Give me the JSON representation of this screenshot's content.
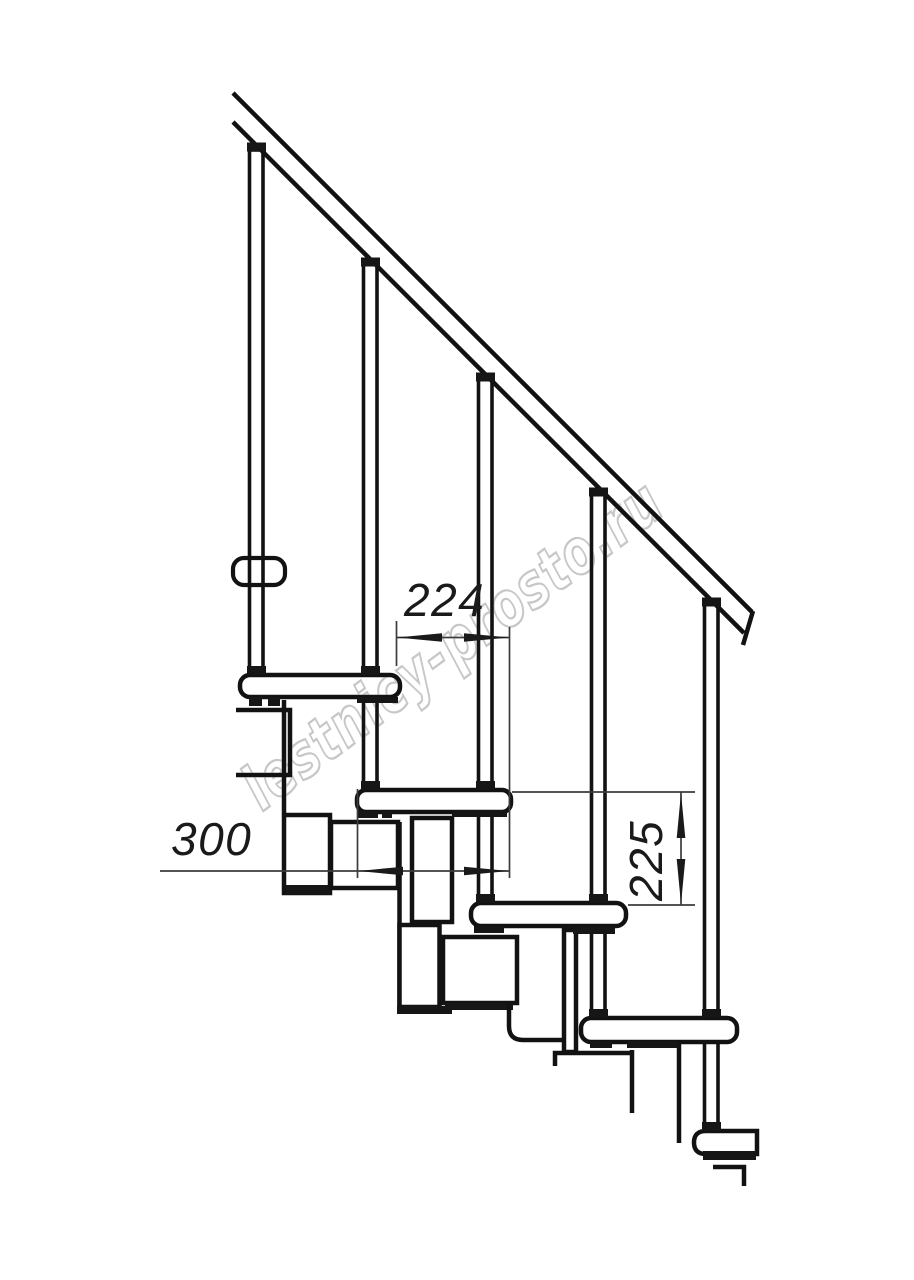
{
  "page": {
    "background": "#ffffff",
    "width": 914,
    "height": 1280,
    "kind": "technical drawing, staircase side elevation"
  },
  "colors": {
    "line": "#121212",
    "dimension_line": "#3c3c3c",
    "dimension_text": "#1a1a1a",
    "watermark": "#c7c7c7"
  },
  "watermark": {
    "text": "lestnicy-prosto.ru"
  },
  "drawing": {
    "handrail": {
      "name": "sloped handrail band"
    },
    "balusters_count": 5,
    "treads_count": 5,
    "wall_bracket": {
      "name": "handrail wall bracket"
    },
    "dimensions": [
      {
        "label": "224",
        "orientation": "horizontal"
      },
      {
        "label": "300",
        "orientation": "horizontal"
      },
      {
        "label": "225",
        "orientation": "vertical"
      }
    ]
  }
}
